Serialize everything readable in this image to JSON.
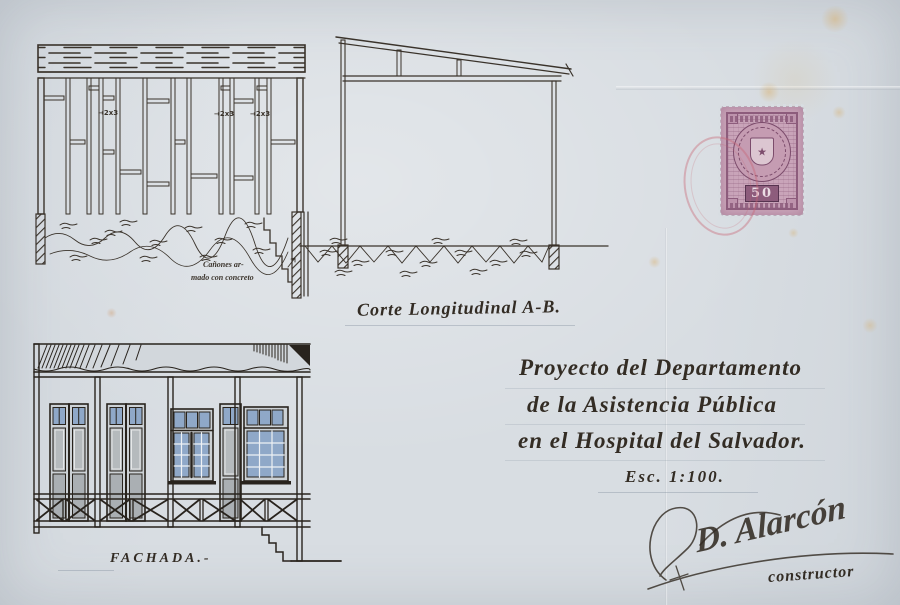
{
  "title_block": {
    "line1": "Proyecto del Departamento",
    "line2": "de la Asistencia Pública",
    "line3": "en el Hospital del Salvador.",
    "scale": "Esc. 1:100."
  },
  "labels": {
    "section": "Corte Longitudinal A-B.",
    "facade": "FACHADA.-",
    "footing_note_line1": "Cañones ar-",
    "footing_note_line2": "mado con concreto",
    "stud1": "→2x3",
    "stud2": "→2x3",
    "stud3": "→2x3"
  },
  "signature": {
    "name": "D. Alarcón",
    "role": "constructor"
  },
  "stamp": {
    "value": "50"
  },
  "colors": {
    "paper": "#d8dde2",
    "ink": "#37312a",
    "stamp_mauve": "#b68ea6",
    "glass_blue": "#8fa8c8",
    "cancel_pink": "#c76473"
  }
}
